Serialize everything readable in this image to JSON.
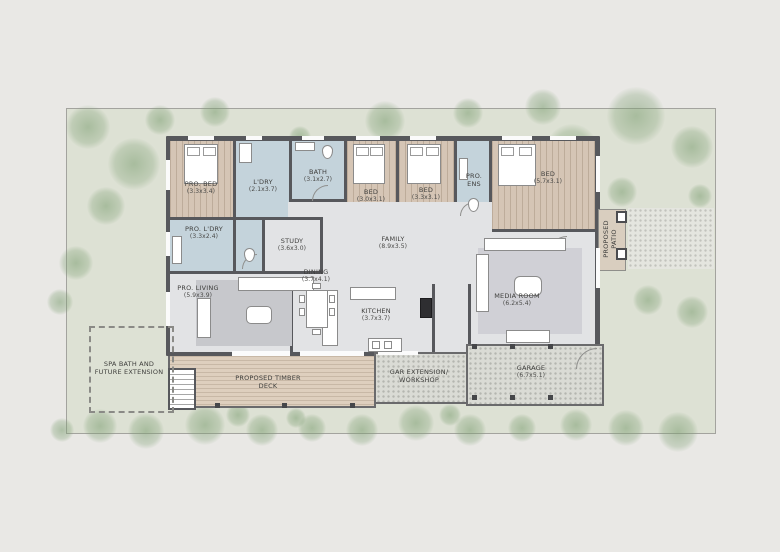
{
  "plan": {
    "rooms": [
      {
        "id": "pro-bed",
        "name": "PRO. BED",
        "dim": "(3.3x3.4)"
      },
      {
        "id": "ldry",
        "name": "L'DRY",
        "dim": "(2.1x3.7)"
      },
      {
        "id": "bath",
        "name": "BATH",
        "dim": "(3.1x2.7)"
      },
      {
        "id": "bed-1",
        "name": "BED",
        "dim": "(3.0x3.1)"
      },
      {
        "id": "bed-2",
        "name": "BED",
        "dim": "(3.3x3.1)"
      },
      {
        "id": "pro-ens",
        "name": "PRO. ENS",
        "dim": ""
      },
      {
        "id": "bed-3",
        "name": "BED",
        "dim": "(5.7x3.1)"
      },
      {
        "id": "pro-ldry",
        "name": "PRO. L'DRY",
        "dim": "(3.3x2.4)"
      },
      {
        "id": "study",
        "name": "STUDY",
        "dim": "(3.6x3.0)"
      },
      {
        "id": "family",
        "name": "FAMILY",
        "dim": "(8.9x3.5)"
      },
      {
        "id": "dining",
        "name": "DINING",
        "dim": "(3.7x4.1)"
      },
      {
        "id": "pro-living",
        "name": "PRO. LIVING",
        "dim": "(5.9x3.9)"
      },
      {
        "id": "kitchen",
        "name": "KITCHEN",
        "dim": "(3.7x3.7)"
      },
      {
        "id": "media-room",
        "name": "MEDIA ROOM",
        "dim": "(6.2x5.4)"
      },
      {
        "id": "spa",
        "name": "SPA BATH AND FUTURE EXTENSION",
        "dim": ""
      },
      {
        "id": "deck",
        "name": "PROPOSED TIMBER DECK",
        "dim": ""
      },
      {
        "id": "workshop",
        "name": "GAR EXTENSION/ WORKSHOP",
        "dim": ""
      },
      {
        "id": "garage",
        "name": "GARAGE",
        "dim": "(6.7x5.1)"
      },
      {
        "id": "patio",
        "name": "PROPOSED PATIO",
        "dim": ""
      }
    ],
    "colors": {
      "wall": "#57585c",
      "wood_floor": "#d5c5b5",
      "wet_area": "#c4d3db",
      "interior_floor": "#e2e3e5",
      "deck": "#decfbe",
      "lawn": "#dde1d4",
      "tree": "#7c9e71",
      "gravel": "#dadbd5",
      "page_background": "#e9e8e5"
    }
  }
}
